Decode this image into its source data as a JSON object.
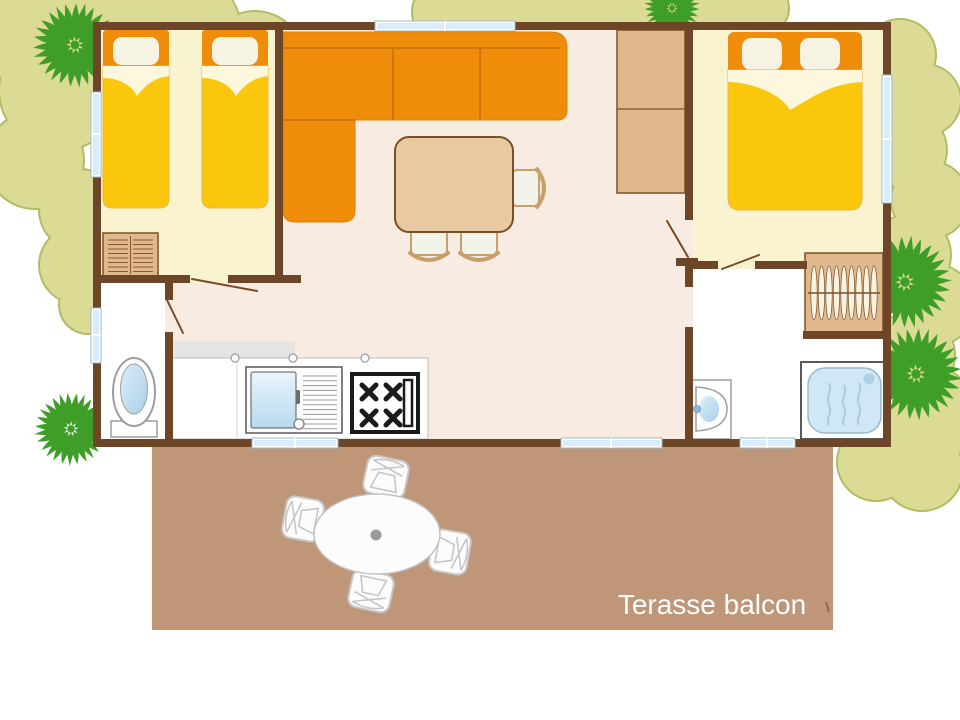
{
  "floor_plan": {
    "terrace": {
      "label": "Terasse balcon"
    },
    "colors": {
      "wall_brown": "#6d4627",
      "living_floor": "#f8ebe1",
      "bedroom_floor": "#faf3cf",
      "bed_yellow": "#fbc70d",
      "accent_orange": "#ef8c0a",
      "furniture_tan": "#dfb88c",
      "terrace_tan": "#bf9678",
      "bush_green": "#dcdb95",
      "bush_outline_green": "#b2bc63",
      "palm_green": "#3f9e28",
      "water_blue": "#cfe7f6",
      "terrace_label_color": "#ffffff"
    },
    "icons": [
      "single-bed-icon",
      "double-bed-icon",
      "corner-sofa-icon",
      "dining-table-icon",
      "dining-chair-icon",
      "dresser-icon",
      "tall-cabinet-icon",
      "wardrobe-icon",
      "kitchen-sink-icon",
      "gas-hob-icon",
      "toilet-icon",
      "washbasin-icon",
      "shower-icon",
      "window-icon",
      "door-swing-icon",
      "palm-tree-icon",
      "bush-icon",
      "terrace-table-icon",
      "garden-chair-icon"
    ]
  }
}
